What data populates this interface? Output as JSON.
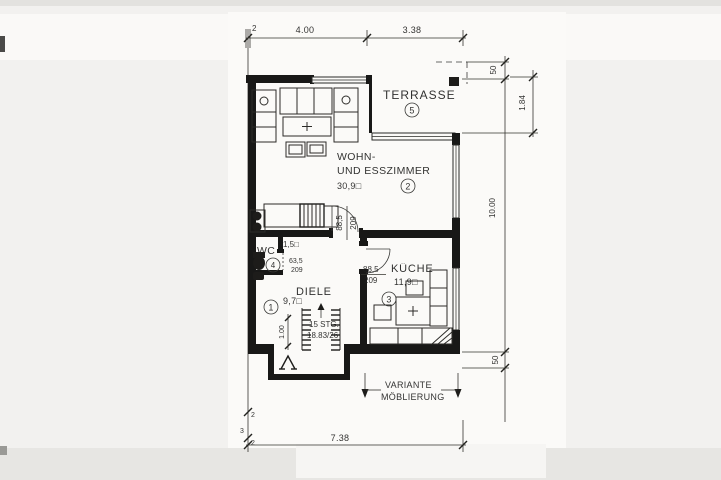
{
  "plan": {
    "rooms": {
      "terrasse": {
        "name": "TERRASSE",
        "number": "5"
      },
      "wohn_esszimmer": {
        "name_line1": "WOHN-",
        "name_line2": "UND ESSZIMMER",
        "area": "30,9□",
        "number": "2"
      },
      "kueche": {
        "name": "KÜCHE",
        "area": "11,9□",
        "number": "3"
      },
      "diele": {
        "name": "DIELE",
        "area": "9,7□",
        "number": "1"
      },
      "wc": {
        "name": "WC",
        "area": "1,5□",
        "number": "4"
      }
    },
    "doors": {
      "wohnzimmer": {
        "width": "88,5",
        "height": "209"
      },
      "kueche": {
        "width": "88,5",
        "height": "209"
      },
      "wc": {
        "width": "63,5",
        "height": "209"
      }
    },
    "stairs": {
      "line1": "15 STG.",
      "line2": "18.83/26"
    },
    "note": {
      "line1": "VARIANTE",
      "line2": "MÖBLIERUNG"
    },
    "dims": {
      "top_offset": "2",
      "top_a": "4.00",
      "top_b": "3.38",
      "total_width": "7.38",
      "right_overhang_top": "50",
      "terrace_depth": "1.84",
      "house_depth": "10.00",
      "right_overhang_bottom": "50",
      "bottom_small_a": "2",
      "bottom_small_b": "3",
      "bottom_small_c": "2",
      "hall_width": "1.00"
    }
  }
}
